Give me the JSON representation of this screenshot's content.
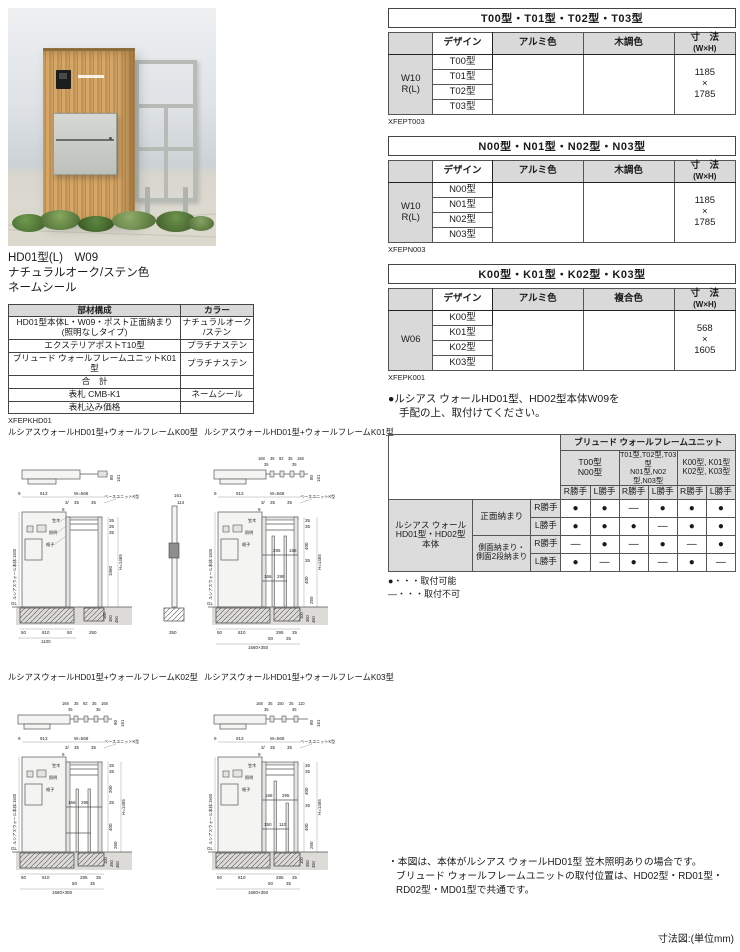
{
  "photo": {
    "caption_line1": "HD01型(L)　W09",
    "caption_line2": "ナチュラルオーク/ステン色",
    "caption_line3": "ネームシール"
  },
  "parts_table": {
    "header_left": "部材構成",
    "header_right": "カラー",
    "rows": [
      {
        "name": "HD01型本体L・W09・ポスト正面納まり\n(照明なしタイプ)",
        "color": "ナチュラルオーク\n/ステン"
      },
      {
        "name": "エクステリアポストT10型",
        "color": "プラチナステン"
      },
      {
        "name": "ブリュード ウォールフレームユニットK01型",
        "color": "プラチナステン"
      },
      {
        "name": "合　計",
        "color": ""
      },
      {
        "name": "表札 CMB-K1",
        "color": "ネームシール"
      },
      {
        "name": "表札込み価格",
        "color": ""
      }
    ],
    "code": "XFEPKHD01"
  },
  "spec_tables": [
    {
      "title": "T00型・T01型・T02型・T03型",
      "c_design": "デザイン",
      "c_alumi": "アルミ色",
      "c3": "木調色",
      "dim1": "寸　法",
      "dim2": "(W×H)",
      "stub0": "W10",
      "stub1": "R(L)",
      "designs": [
        "T00型",
        "T01型",
        "T02型",
        "T03型"
      ],
      "size0": "1185",
      "sizex": "×",
      "size1": "1785",
      "code": "XFEPT003"
    },
    {
      "title": "N00型・N01型・N02型・N03型",
      "c_design": "デザイン",
      "c_alumi": "アルミ色",
      "c3": "木調色",
      "dim1": "寸　法",
      "dim2": "(W×H)",
      "stub0": "W10",
      "stub1": "R(L)",
      "designs": [
        "N00型",
        "N01型",
        "N02型",
        "N03型"
      ],
      "size0": "1185",
      "sizex": "×",
      "size1": "1785",
      "code": "XFEPN003"
    },
    {
      "title": "K00型・K01型・K02型・K03型",
      "c_design": "デザイン",
      "c_alumi": "アルミ色",
      "c3": "複合色",
      "dim1": "寸　法",
      "dim2": "(W×H)",
      "stub0": "W06",
      "designs": [
        "K00型",
        "K01型",
        "K02型",
        "K03型"
      ],
      "size0": "568",
      "sizex": "×",
      "size1": "1605",
      "code": "XFEPK001"
    }
  ],
  "order_note": {
    "line1": "●ルシアス ウォールHD01型、HD02型本体W09を",
    "line2": "手配の上、取付けてください。"
  },
  "compat": {
    "top_header": "ブリュード ウォールフレームユニット",
    "groups": [
      {
        "l1": "T00型",
        "l2": "N00型"
      },
      {
        "l1": "T01型,T02型,T03型",
        "l2": "N01型,N02型,N03型"
      },
      {
        "l1": "K00型, K01型",
        "l2": "K02型, K03型"
      }
    ],
    "hand_r": "R勝手",
    "hand_l": "L勝手",
    "row_header_l1": "ルシアス ウォール",
    "row_header_l2": "HD01型・HD02型",
    "row_header_l3": "本体",
    "front_label": "正面納まり",
    "side_label_l1": "側面納まり・",
    "side_label_l2": "側面2段納まり",
    "rows": [
      [
        "●",
        "●",
        "―",
        "●",
        "●",
        "●"
      ],
      [
        "●",
        "●",
        "●",
        "―",
        "●",
        "●"
      ],
      [
        "―",
        "●",
        "―",
        "●",
        "―",
        "●"
      ],
      [
        "●",
        "―",
        "●",
        "―",
        "●",
        "―"
      ]
    ],
    "legend1": "●・・・取付可能",
    "legend2": "―・・・取付不可"
  },
  "dwg": {
    "titles": [
      "ルシアスウォールHD01型+ウォールフレームK00型",
      "ルシアスウォールHD01型+ウォールフレームK01型",
      "ルシアスウォールHD01型+ウォールフレームK02型",
      "ルシアスウォールHD01型+ウォールフレームK03型"
    ],
    "c": {
      "d9": "9",
      "d913": "913",
      "w568": "W=568",
      "d3": "3/",
      "d35": "35",
      "gl": "GL",
      "h1465": "H=1465",
      "f100": "100",
      "f350": "350",
      "f450": "450",
      "b50": "50",
      "b810": "810",
      "wallh": "ルシアスウォール本体:1500",
      "unit": "ベースユニットK型",
      "kasagi": "笠木",
      "shomei": "照明",
      "koshi": "格子",
      "p80": "80",
      "p161": "161"
    },
    "k00": {
      "v1060": "1060",
      "b50r": "50",
      "b1100": "1100",
      "b250": "250",
      "s161": "161",
      "s114": "114",
      "s350": "350"
    },
    "k01": {
      "t168": "168",
      "t92": "92",
      "i295": "295",
      "i168": "168",
      "i166": "166",
      "v400": "400",
      "v260": "260",
      "b295": "295",
      "b35": "35",
      "btot": "1680×350"
    },
    "k02": {
      "t168": "168",
      "t92": "92",
      "i166": "166",
      "i295": "295",
      "v200": "200",
      "v400": "400",
      "v260": "260",
      "b295": "295",
      "b35": "35",
      "btot": "1680×350"
    },
    "k03": {
      "t168": "168",
      "t150": "150",
      "t110": "110",
      "i168": "168",
      "i295": "295",
      "v400": "400",
      "v260": "260",
      "b295": "295",
      "b35": "35",
      "btot": "1680×350"
    }
  },
  "notes": {
    "line1": "・本図は、本体がルシアス ウォールHD01型 笠木照明ありの場合です。",
    "line2": "ブリュード ウォールフレームユニットの取付位置は、HD02型・RD01型・",
    "line3": "RD02型・MD01型で共通です。",
    "unit": "寸法図:(単位mm)"
  }
}
